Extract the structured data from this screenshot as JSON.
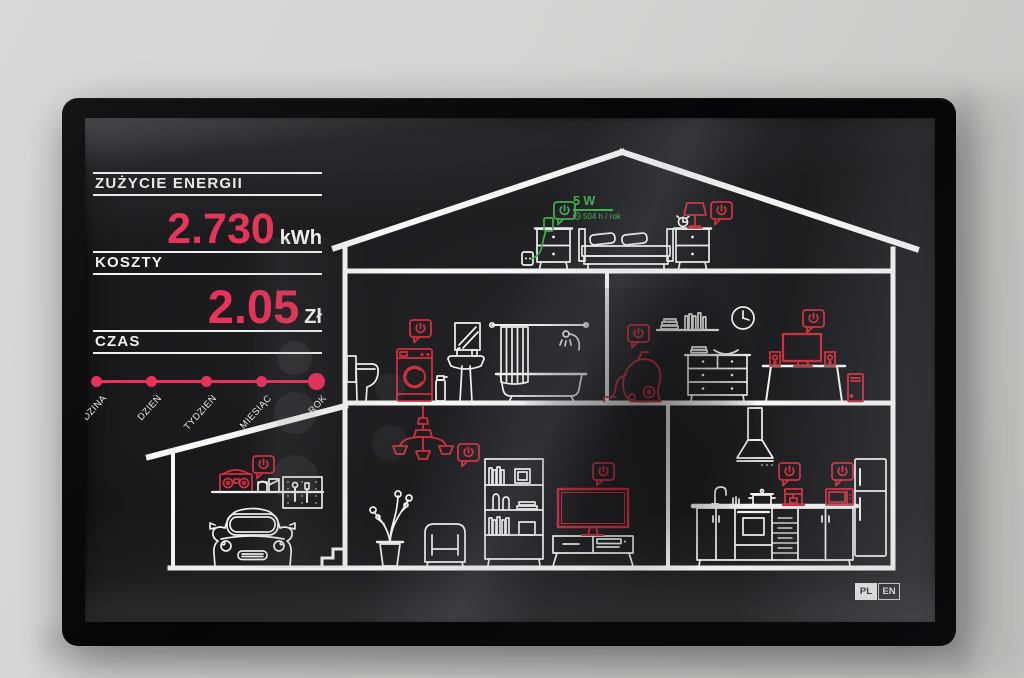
{
  "screen": {
    "panel": {
      "energy": {
        "label": "ZUŻYCIE ENERGII",
        "value": "2.730",
        "unit": "kWh"
      },
      "cost": {
        "label": "KOSZTY",
        "value": "2.05",
        "unit": "Zł"
      },
      "time_label": "CZAS",
      "timeline": {
        "options": [
          "GODZINA",
          "DZIEŃ",
          "TYDZIEŃ",
          "MIESIĄC",
          "ROK"
        ],
        "selected": "ROK"
      }
    },
    "callout": {
      "power": "5 W",
      "usage": "504 h / rok",
      "device": "phone-charger"
    },
    "language": {
      "options": [
        "PL",
        "EN"
      ],
      "selected": "PL"
    },
    "colors": {
      "accent_pink": "#e73358",
      "device_red": "#d02f3d",
      "active_green": "#3fae4c",
      "line_white": "#f2f2f2"
    },
    "callout_devices": [
      "phone-charger",
      "bedside-lamp",
      "washing-machine",
      "vacuum-cleaner",
      "tv-upstairs",
      "boombox",
      "chandelier",
      "tv-living-room",
      "coffee-maker",
      "microwave"
    ]
  }
}
